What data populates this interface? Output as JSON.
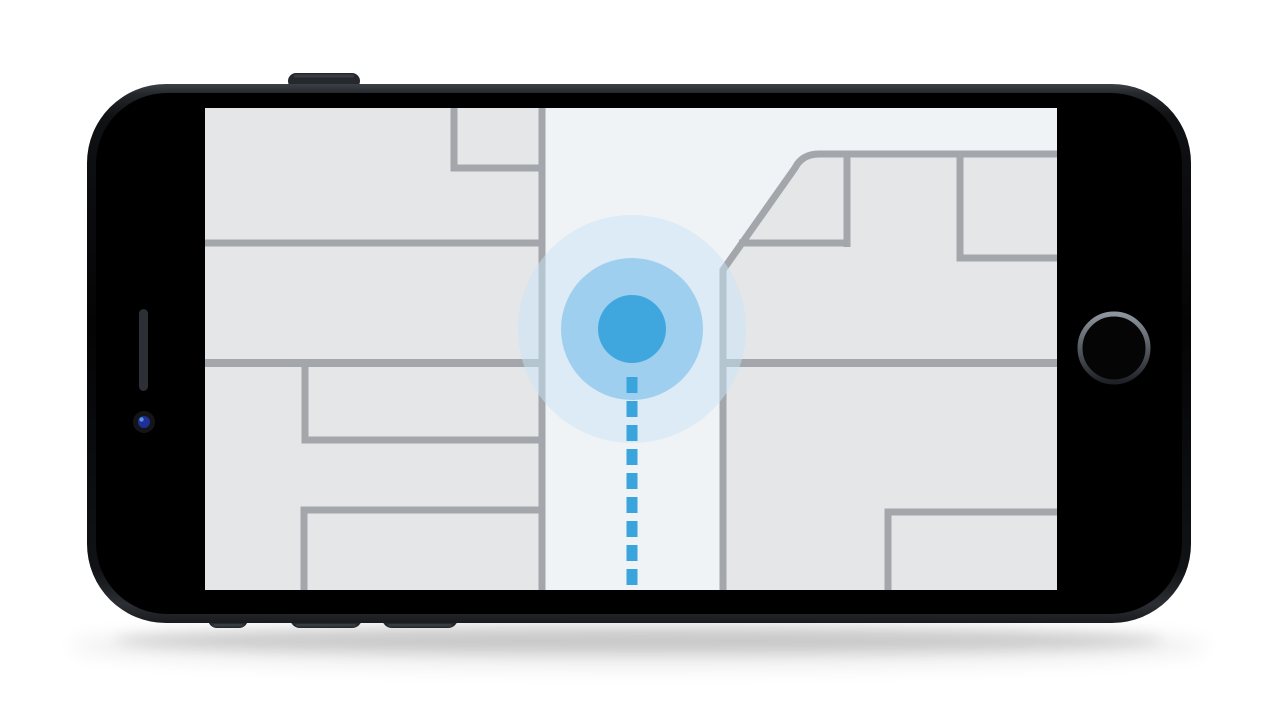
{
  "device": {
    "screen_bezel_color": "#000000",
    "buttons_color": "#25282d",
    "home_button": {
      "ring_light": "#8e959d",
      "ring_dark": "#1e2125"
    },
    "earpiece_color": "#2c2f34",
    "camera_lens_color": "#1f2f96"
  },
  "map": {
    "street_color": "#f0f3f5",
    "block_color": "#e4e6e8",
    "line_color": "#a3a7ab",
    "location": {
      "dot_color": "#3fa7de",
      "pulse_color": "#60b3e7",
      "halo_color": "#c8e3f6"
    },
    "route": {
      "dash_color": "#3aa4dd"
    }
  }
}
